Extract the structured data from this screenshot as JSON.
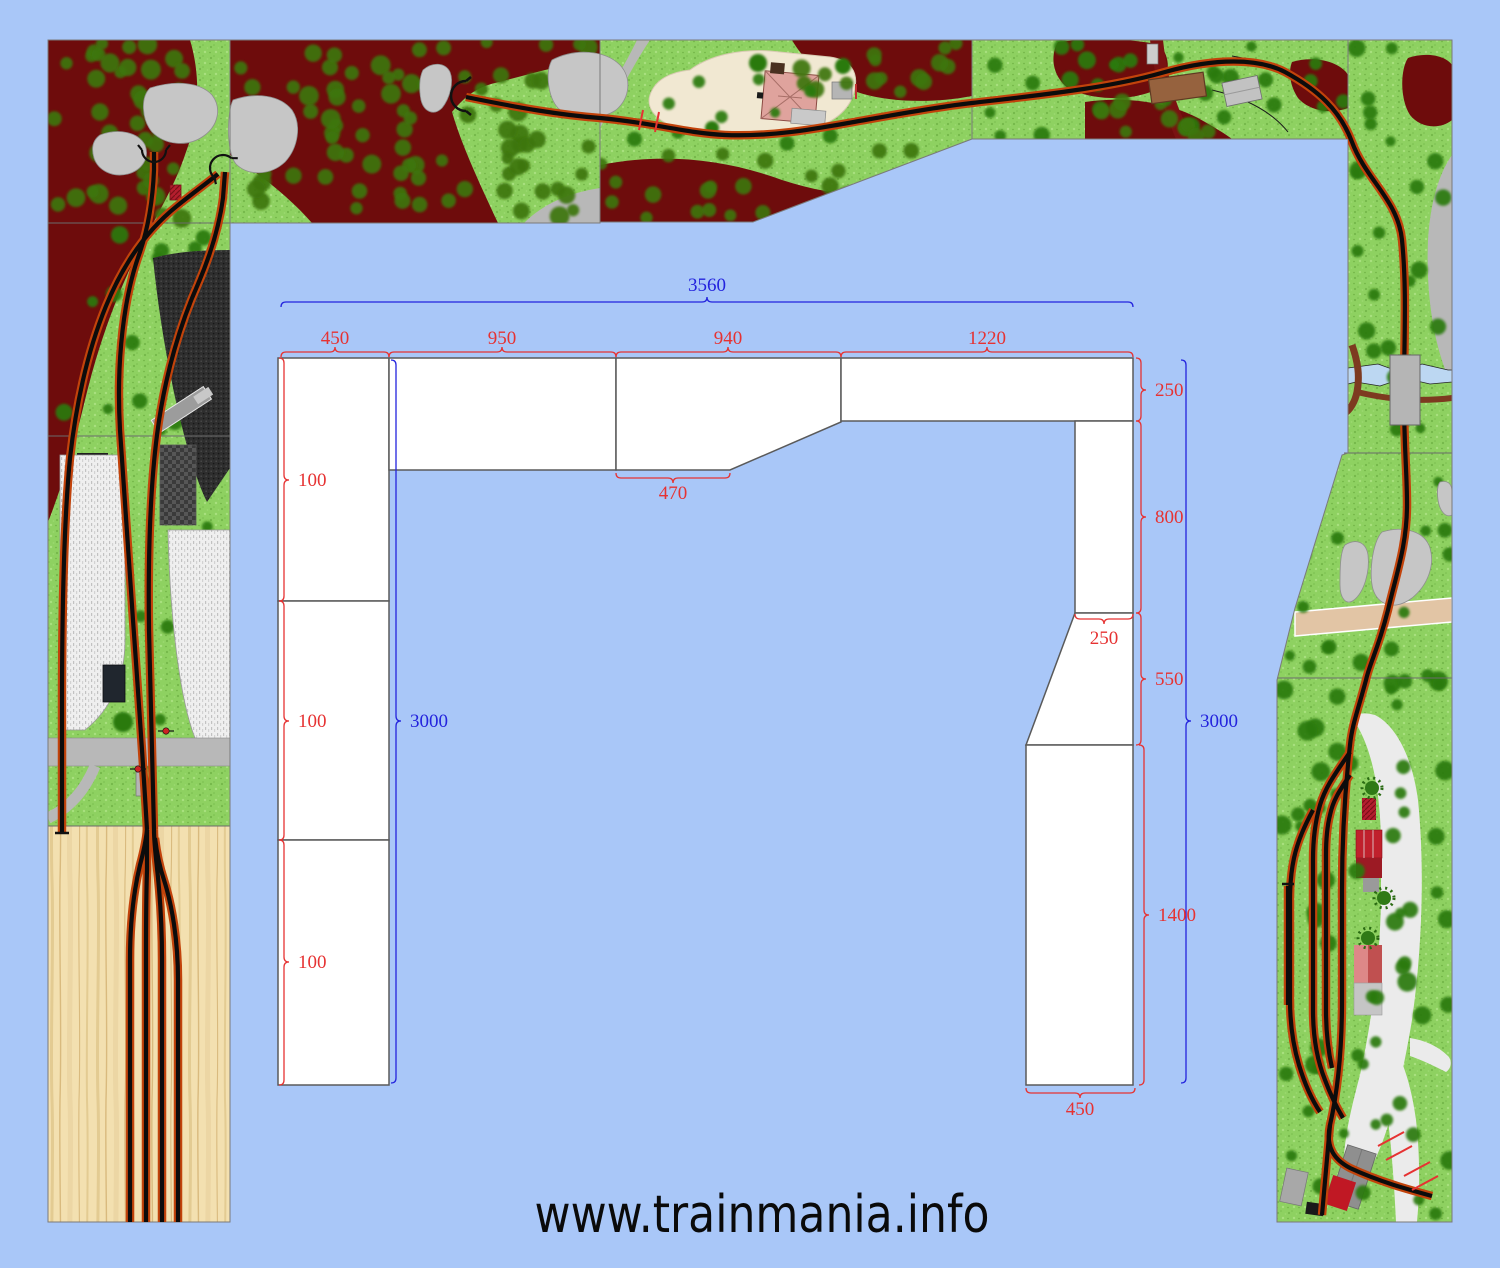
{
  "watermark": {
    "text": "www.trainmania.info"
  },
  "drawing": {
    "overall": {
      "top_width": "3560",
      "left_height": "3000",
      "right_height": "3000"
    },
    "top_widths": [
      "450",
      "950",
      "940",
      "1220"
    ],
    "left_heights": [
      "100",
      "100",
      "100"
    ],
    "right_heights": [
      "250",
      "800",
      "550",
      "1400"
    ],
    "detail_dims": {
      "middle_board_notch_width": "470",
      "right_column_top_width": "250",
      "right_column_bottom_width": "450"
    }
  },
  "palette": {
    "background": "#a9c7f8",
    "board_fill": "#ffffff",
    "board_stroke": "#5a5a5a",
    "dimension_red": "#e63232",
    "dimension_blue": "#2323dd",
    "grass": "#8ed161",
    "hidden_forest": "#6e0c0c",
    "tree_green": "#2c7a10",
    "tree_on_forest": "#3e7611",
    "rock_gray": "#c6c6c6",
    "road_gray": "#b8b8b8",
    "road_dark_red": "#7a1212",
    "road_tan": "#e2c5a5",
    "bridge_brown": "#96623e",
    "stream_blue": "#bcd7f2",
    "track_black": "#0c0c0c",
    "track_edge_orange": "#c2430b",
    "wood": "#f3e0b0",
    "paved_white": "#ebebeb",
    "building_red": "#c0202c",
    "building_pink": "#dfa39d",
    "charcoal": "#2e2e2e"
  }
}
